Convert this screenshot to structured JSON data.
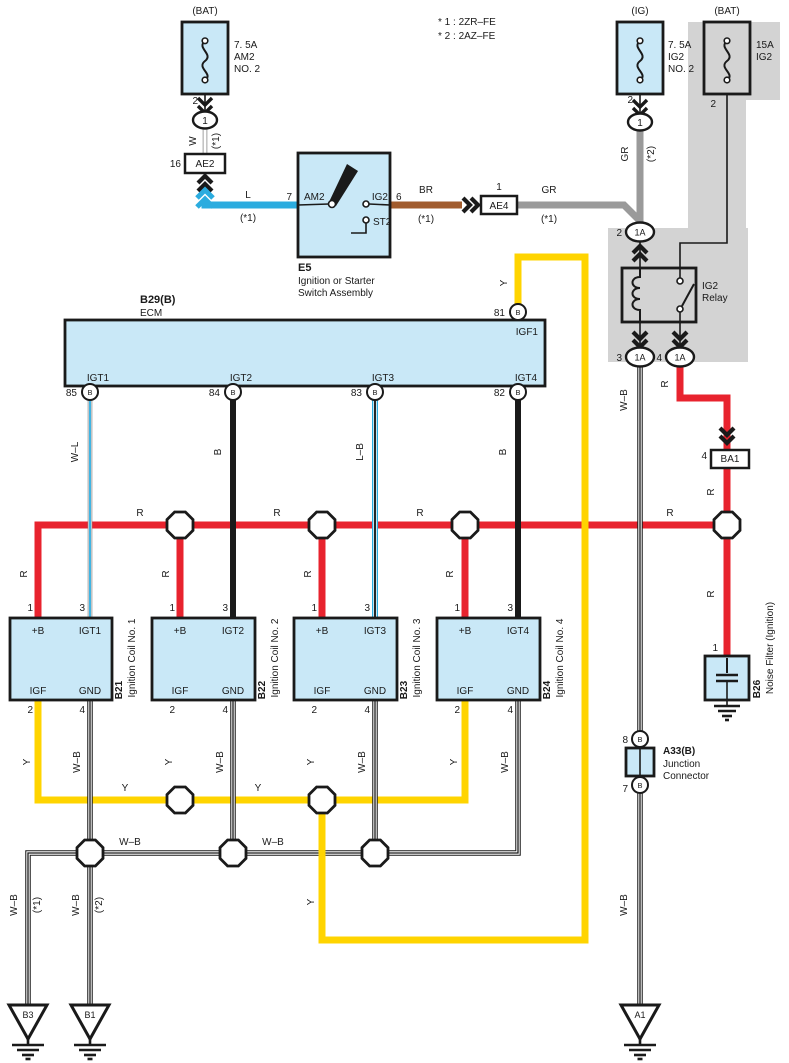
{
  "colors": {
    "red": "#e8232e",
    "yellow": "#ffd400",
    "blue": "#2bacdf",
    "brown": "#a15c2e",
    "gray_wire": "#9a9a9a",
    "component_fill": "#c9e8f7",
    "backdrop": "#d3d3d3",
    "line": "#1a1a1a"
  },
  "notes": {
    "line1": "* 1 : 2ZR–FE",
    "line2": "* 2 : 2AZ–FE"
  },
  "fuses": {
    "am2": {
      "bus": "(BAT)",
      "rating": "7. 5A",
      "name": "AM2",
      "name2": "NO. 2",
      "pin": "2",
      "conn": "1"
    },
    "ig2": {
      "bus": "(IG)",
      "rating": "7. 5A",
      "name": "IG2",
      "name2": "NO. 2",
      "pin": "2",
      "conn": "1"
    },
    "ig2_main": {
      "bus": "(BAT)",
      "rating": "15A",
      "name": "IG2",
      "pin": "2"
    }
  },
  "connectors": {
    "ae2": {
      "pin": "16",
      "label": "AE2"
    },
    "ae4": {
      "pin": "1",
      "label": "AE4"
    },
    "ba1": {
      "pin": "4",
      "label": "BA1"
    }
  },
  "ignition_switch": {
    "id": "E5",
    "name_line1": "Ignition or Starter",
    "name_line2": "Switch Assembly",
    "pin7": "7",
    "am2": "AM2",
    "ig2": "IG2",
    "pin6": "6",
    "st2": "ST2"
  },
  "relay": {
    "name_line1": "IG2",
    "name_line2": "Relay",
    "pin2": "2",
    "pin3": "3",
    "pin4": "4",
    "conn": "1A"
  },
  "ecm": {
    "id": "B29(B)",
    "name": "ECM",
    "pin81": "81",
    "igf1": "IGF1",
    "b": "B",
    "pins": [
      {
        "num": "85",
        "label": "IGT1"
      },
      {
        "num": "84",
        "label": "IGT2"
      },
      {
        "num": "83",
        "label": "IGT3"
      },
      {
        "num": "82",
        "label": "IGT4"
      }
    ]
  },
  "coils": [
    {
      "id": "B21",
      "name": "Ignition Coil No. 1",
      "igt": "IGT1"
    },
    {
      "id": "B22",
      "name": "Ignition Coil No. 2",
      "igt": "IGT2"
    },
    {
      "id": "B23",
      "name": "Ignition Coil No. 3",
      "igt": "IGT3"
    },
    {
      "id": "B24",
      "name": "Ignition Coil No. 4",
      "igt": "IGT4"
    }
  ],
  "coil_pins": {
    "plus_b": "+B",
    "igf": "IGF",
    "gnd": "GND",
    "n1": "1",
    "n2": "2",
    "n3": "3",
    "n4": "4"
  },
  "junction_connector": {
    "id": "A33(B)",
    "name_line1": "Junction",
    "name_line2": "Connector",
    "pin8": "8",
    "pin7": "7",
    "b": "B"
  },
  "noise_filter": {
    "id": "B26",
    "name": "Noise Filter (Ignition)",
    "pin1": "1"
  },
  "grounds": {
    "b3": "B3",
    "b1": "B1",
    "a1": "A1"
  },
  "wire_labels": {
    "w": "W",
    "l": "L",
    "br": "BR",
    "gr": "GR",
    "r": "R",
    "y": "Y",
    "b": "B",
    "w_b": "W–B",
    "w_l": "W–L",
    "l_b": "L–B",
    "star1": "(*1)",
    "star2": "(*2)"
  }
}
